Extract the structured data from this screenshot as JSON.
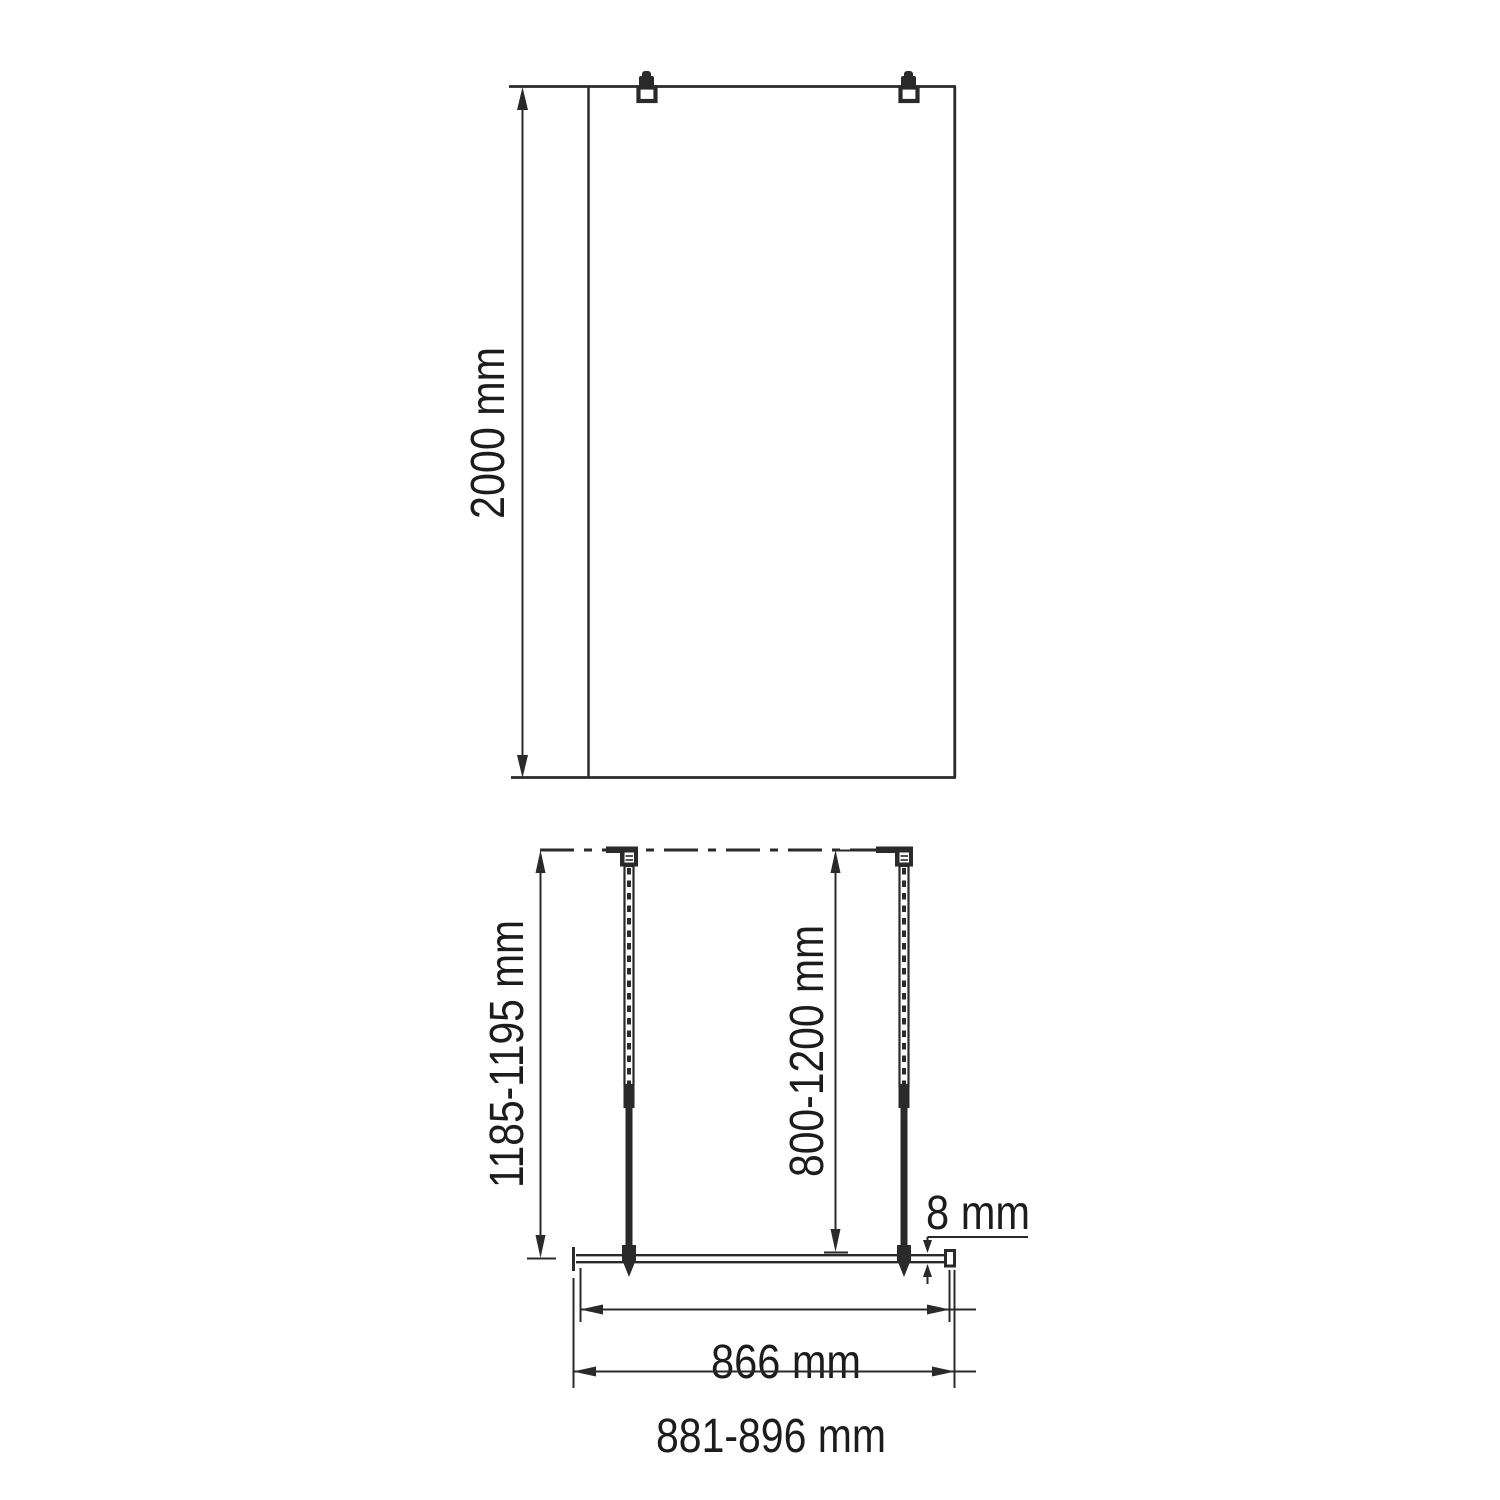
{
  "drawing": {
    "description": "Technical installation diagram of a walk-in shower glass panel with two wall support bars",
    "colors": {
      "line": "#2a2a2a",
      "text": "#1c1c1c",
      "background": "#ffffff"
    },
    "front_view": {
      "height_label": "2000 mm"
    },
    "plan_view": {
      "bar_overall_label": "1185-1195 mm",
      "bar_adjust_label": "800-1200 mm",
      "glass_thickness_label": "8 mm",
      "glass_width_label": "866 mm",
      "overall_width_label": "881-896 mm"
    }
  }
}
